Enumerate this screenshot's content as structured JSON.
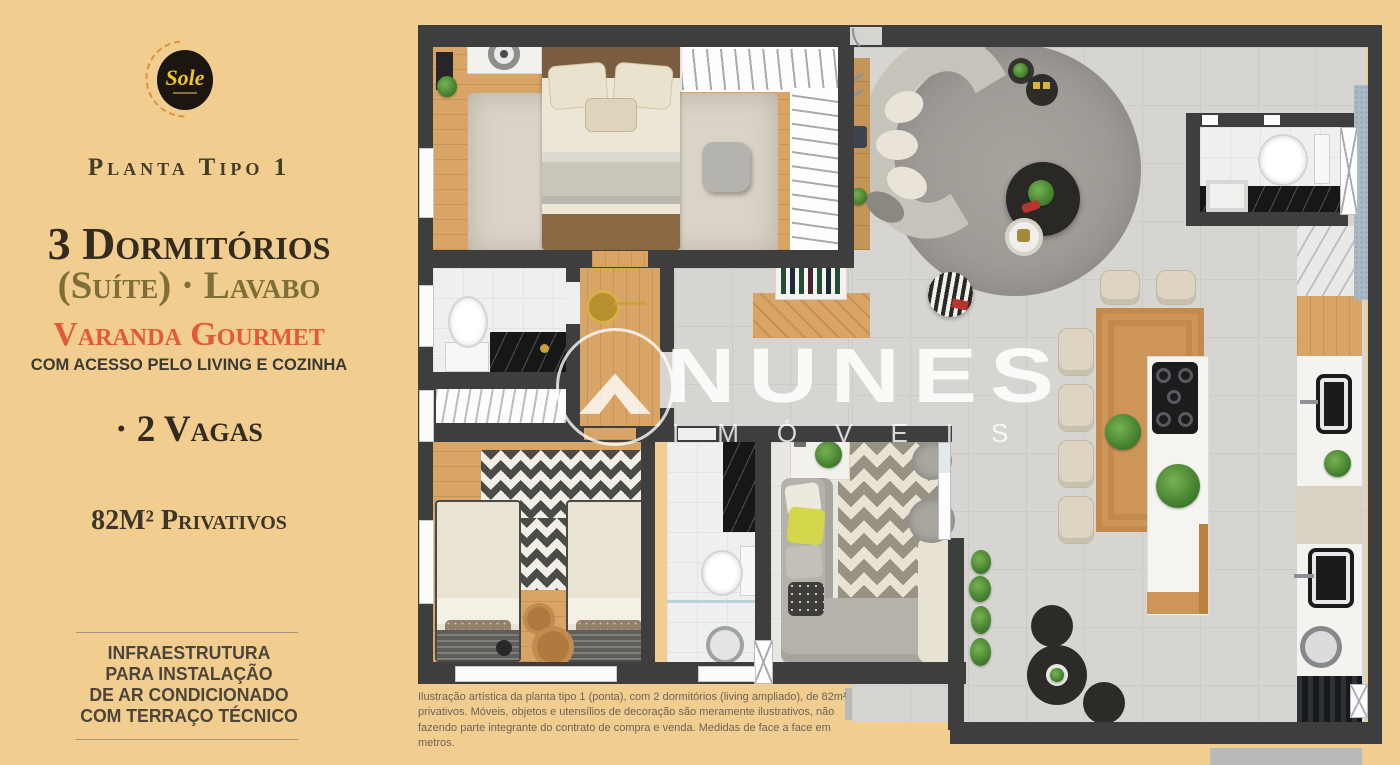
{
  "left_panel": {
    "logo_brand": "Sole",
    "plan_label": "Planta Tipo 1",
    "headline": "3 Dormitórios",
    "headline2": "(Suíte) · Lavabo",
    "feature_title": "Varanda Gourmet",
    "feature_subtitle": "COM ACESSO PELO LIVING E COZINHA",
    "vagas_label": "· 2 Vagas",
    "area_label": "82M² Privativos",
    "infra_lines": [
      "INFRAESTRUTURA",
      "PARA INSTALAÇÃO",
      "DE AR CONDICIONADO",
      "COM TERRAÇO TÉCNICO"
    ]
  },
  "watermark": {
    "brand": "NUNES",
    "segment": "IMÓVEIS"
  },
  "disclaimer": "Ilustração artística da planta tipo 1 (ponta), com 2 dormitórios (living ampliado), de 82m² privativos. Móveis, objetos e utensílios de decoração são meramente ilustrativos, não fazendo parte integrante do contrato de compra e venda. Medidas de face a face em metros.",
  "colors": {
    "background": "#f2cd90",
    "headline_text": "#332c1e",
    "suite_lavabo_text": "#7d6f38",
    "feature_accent": "#e2593b",
    "body_text": "#4c463a",
    "wall": "#3e3e3f",
    "logo_yellow": "#eec32d",
    "logo_circle": "#1b1710",
    "watermark_white": "#ffffff"
  }
}
